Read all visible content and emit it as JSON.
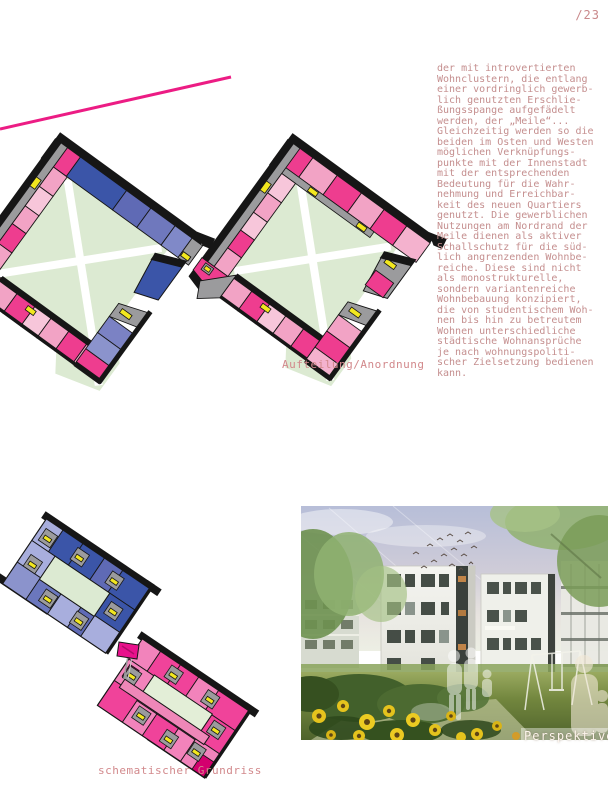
{
  "page": {
    "number": "/23",
    "background": "#ffffff"
  },
  "article": {
    "body": "der mit introvertierten\nWohnclustern, die entlang\neiner vordringlich gewerb-\nlich genutzten Erschlie-\nßungsspange aufgefädelt\nwerden, der „Meile“...\nGleichzeitig werden so die\nbeiden im Osten und Westen\nmöglichen Verknüpfungs-\npunkte mit der Innenstadt\nmit der entsprechenden\nBedeutung für die Wahr-\nnehmung und Erreichbar-\nkeit des neuen Quartiers\ngenutzt. Die gewerblichen\nNutzungen am Nordrand der\nMeile dienen als aktiver\nSchallschutz für die süd-\nlich angrenzenden Wohnbe-\nreiche. Diese sind nicht\nals monostrukturelle,\nsondern variantenreiche\nWohnbebauung konzipiert,\ndie von studentischem Woh-\nnen bis hin zu betreutem\nWohnen unterschiedliche\nstädtische Wohnansprüche\nje nach wohnungspoliti-\nscher Zielsetzung bedienen\nkann."
  },
  "captions": {
    "arrangement": "Aufteilung/Anordnung",
    "floorplan": "schematischer Grundriss",
    "perspective": "Perspektive"
  },
  "colors": {
    "accent_line_pink": "#ec1c84",
    "magenta": "#ee3d8f",
    "light_pink": "#f2a3c5",
    "pale_pink": "#f7c6da",
    "bar_pink": "#ef87b8",
    "dark_blue": "#3b55a8",
    "periwinkle": "#6b77bd",
    "light_periwinkle": "#a8aedd",
    "courtyard_green": "#dcead2",
    "door_yellow": "#f2e71f",
    "wall_gray": "#9b9b9d",
    "edge_black": "#161616",
    "text_rose": "#c9898b"
  }
}
